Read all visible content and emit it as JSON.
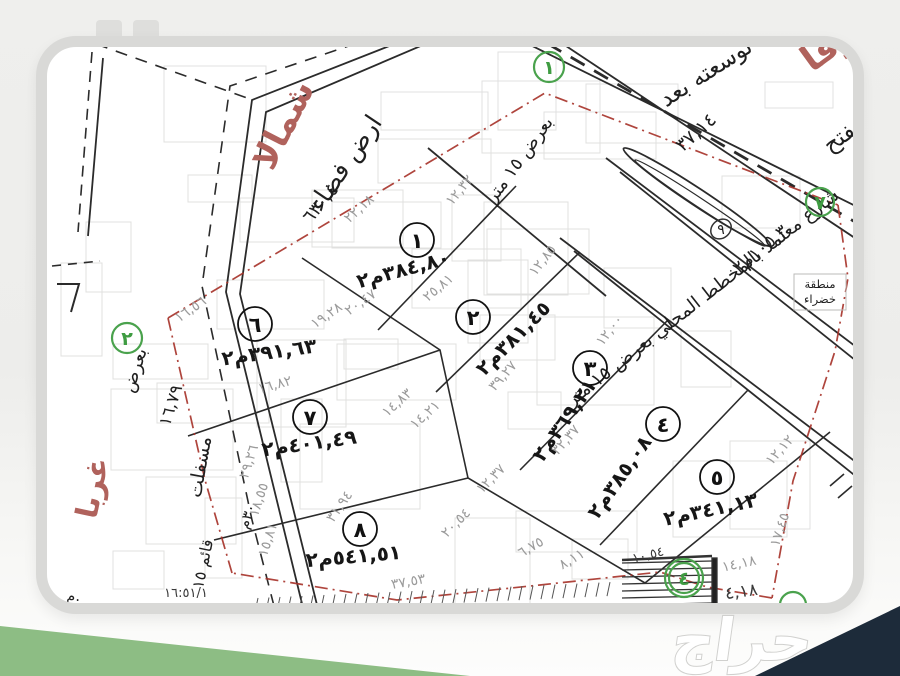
{
  "page": {
    "watermark": "حراج"
  },
  "map": {
    "directions": {
      "north": "شمالا",
      "east": "شرقا",
      "west": "غربا"
    },
    "vacant_land": {
      "label": "ارض فضاء",
      "dim": "٦٣٠,٤"
    },
    "streets": {
      "main": "شارع معتمد بالمخطط المحلي بعرض ١٥ متر",
      "width_note": "بعرض ١٥ متر",
      "expansion": "توسعته بعد",
      "opens": "يفتح",
      "expansion_dim": "٣٧,١٤",
      "west_surface": "مسفلت",
      "west_width": "بعرض",
      "west_dim": "١٦,٧٩",
      "west_existing": "قائم ١٥",
      "west_width2": "٣٠م",
      "edge_mark": "م."
    },
    "green_area": {
      "line1": "منطقة",
      "line2": "خضراء",
      "plot_id": "٩",
      "area": "١٠٥,٣م٢"
    },
    "plots": [
      {
        "id": "١",
        "area": "٣٨٤,٨٠م٢"
      },
      {
        "id": "٢",
        "area": "٣٨١,٤٥م٢"
      },
      {
        "id": "٣",
        "area": "٣٦٩,٢١م٢"
      },
      {
        "id": "٤",
        "area": "٣٨٥,٠٨م٢"
      },
      {
        "id": "٥",
        "area": "٣٤١,١٣م٢"
      },
      {
        "id": "٦",
        "area": "٣٩١,٦٣م٢"
      },
      {
        "id": "٧",
        "area": "٤٠١,٤٩م٢"
      },
      {
        "id": "٨",
        "area": "٥٤١,٥١م٢"
      }
    ],
    "green_markers": {
      "m1": "١",
      "m2": "٢",
      "m4": "٤",
      "m7": "٧"
    },
    "dimensions": [
      "٢٢,١٨",
      "١٢,٣٢",
      "٢٥,٨١",
      "١٢,٨٥",
      "١٢,٠٠",
      "٢٠,٤٧",
      "١٩,٢٨",
      "٣٩,٢٧",
      "٣٢,٣٧",
      "١٢,٣٧",
      "٢٠,٥٤",
      "٦,٧٥",
      "٨,١١",
      "١٤,٨٣",
      "١٤,٢١",
      "١٦,٨٢",
      "١٦,٥٦",
      "١٢,١٢",
      "١٧,٤٥",
      "١٤,١٨",
      "٣٧,٥٣",
      "٣١,٩٤",
      "٢٩,٢٦",
      "١٨,٥٥",
      "١٥,٨١",
      "٤,١٨",
      "١٠,٥٤",
      "١٦:٥١/١"
    ]
  }
}
